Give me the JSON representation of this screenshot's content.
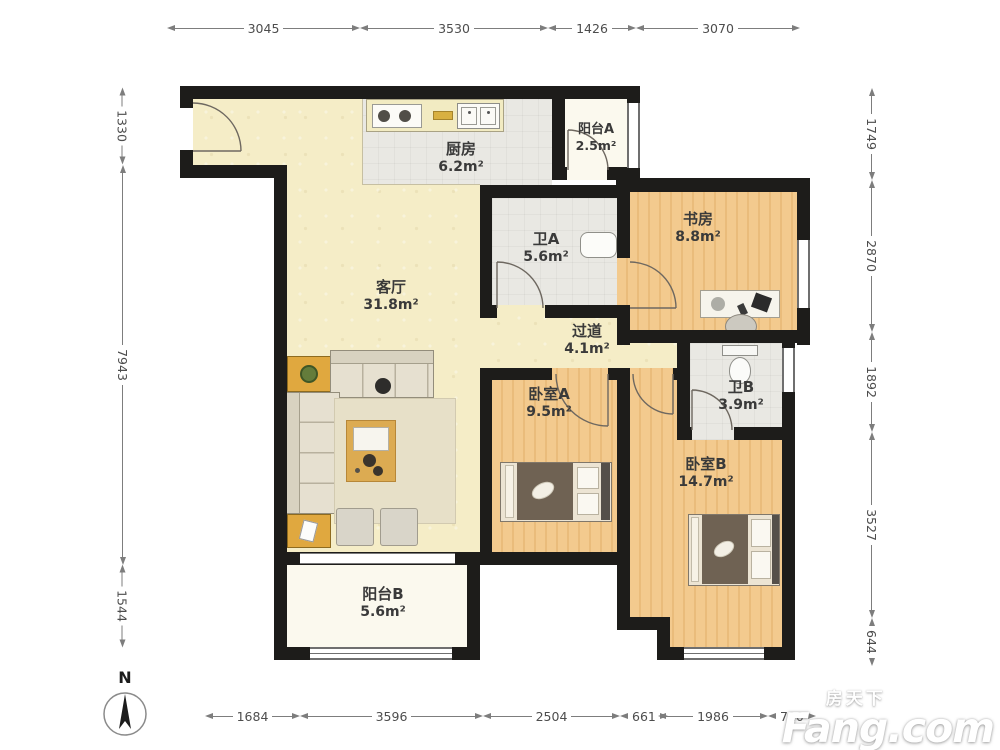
{
  "plan_title": "三室两厅两卫户型图",
  "rooms": {
    "living": {
      "name": "客厅",
      "area": "31.8m²"
    },
    "kitchen": {
      "name": "厨房",
      "area": "6.2m²"
    },
    "balcony_a": {
      "name": "阳台A",
      "area": "2.5m²"
    },
    "study": {
      "name": "书房",
      "area": "8.8m²"
    },
    "bath_a": {
      "name": "卫A",
      "area": "5.6m²"
    },
    "corridor": {
      "name": "过道",
      "area": "4.1m²"
    },
    "bedroom_a": {
      "name": "卧室A",
      "area": "9.5m²"
    },
    "bath_b": {
      "name": "卫B",
      "area": "3.9m²"
    },
    "bedroom_b": {
      "name": "卧室B",
      "area": "14.7m²"
    },
    "balcony_b": {
      "name": "阳台B",
      "area": "5.6m²"
    }
  },
  "dimensions_mm": {
    "top": [
      "3045",
      "3530",
      "1426",
      "3070"
    ],
    "bottom": [
      "1684",
      "3596",
      "2504",
      "661",
      "1986",
      "720"
    ],
    "left": [
      "1330",
      "7943",
      "1544"
    ],
    "right": [
      "1749",
      "2870",
      "1892",
      "3527",
      "644"
    ]
  },
  "compass": {
    "label": "N"
  },
  "watermark": {
    "cn": "房天下",
    "en": "Fang.com"
  },
  "colors": {
    "wall": "#1d1c1a",
    "living_floor": "#f5edc7",
    "wood_floor": "#f3ca8e",
    "tile_floor": "#e9e8e3",
    "balcony_floor": "#fbf9ee",
    "dim_text": "#4d4d4d"
  }
}
